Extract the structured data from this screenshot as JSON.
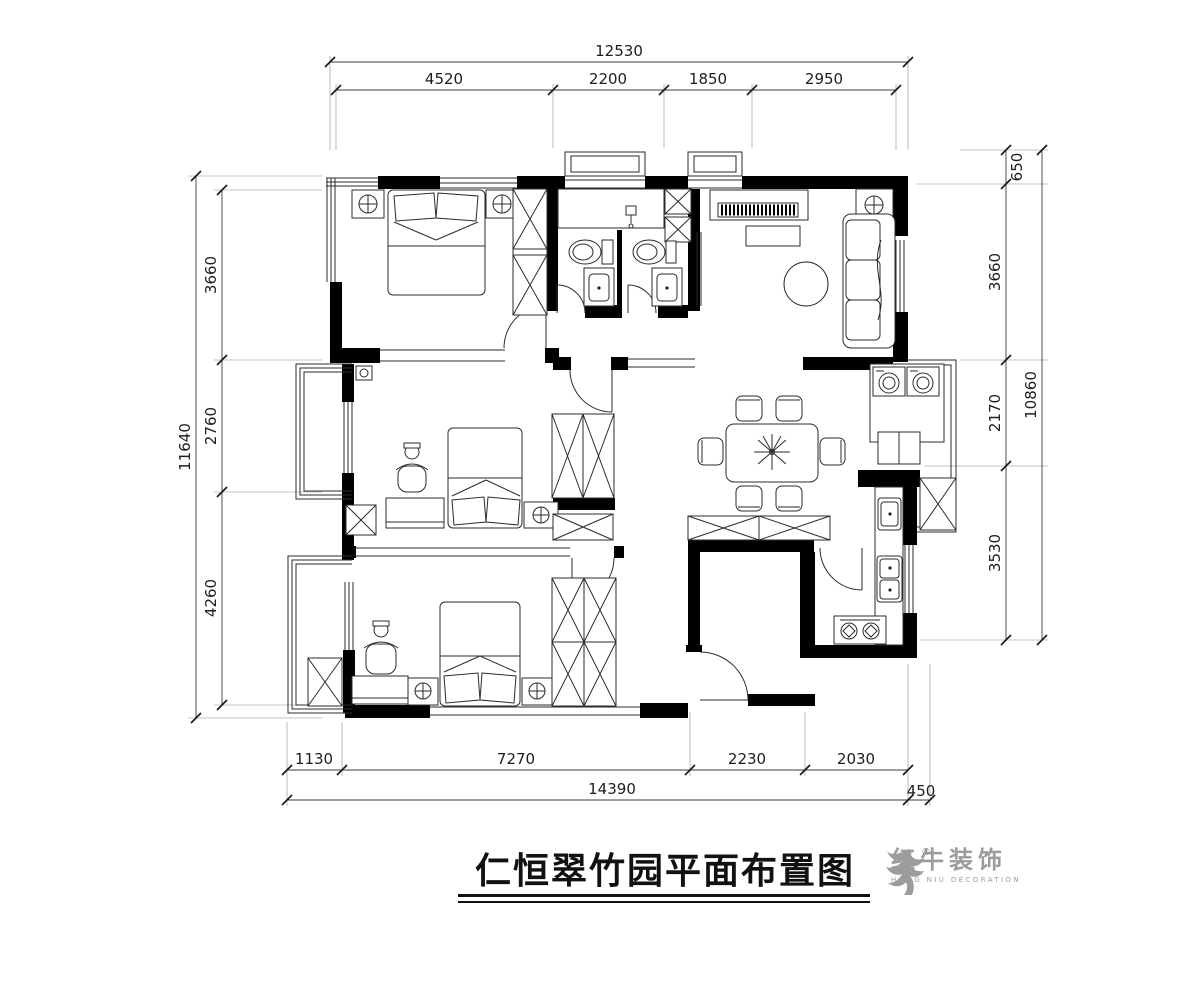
{
  "title": {
    "text": "仁恒翠竹园平面布置图"
  },
  "logo": {
    "registered": "®",
    "brand": "红牛装饰",
    "subtitle": "HONG NIU DECORATION",
    "color": "#9c9c9c"
  },
  "dims": {
    "top": {
      "overall": "12530",
      "seg": [
        "4520",
        "2200",
        "1850",
        "2950"
      ]
    },
    "left": {
      "overall": "11640",
      "seg": [
        "3660",
        "2760",
        "4260"
      ]
    },
    "right": {
      "offset": "650",
      "overall": "10860",
      "seg": [
        "3660",
        "2170",
        "3530"
      ]
    },
    "bottom": {
      "overall": "14390",
      "seg": [
        "1130",
        "7270",
        "2230",
        "2030"
      ],
      "offset": "450"
    }
  },
  "colors": {
    "wall": "#000000",
    "line": "#2b2b2b",
    "background": "#ffffff"
  }
}
